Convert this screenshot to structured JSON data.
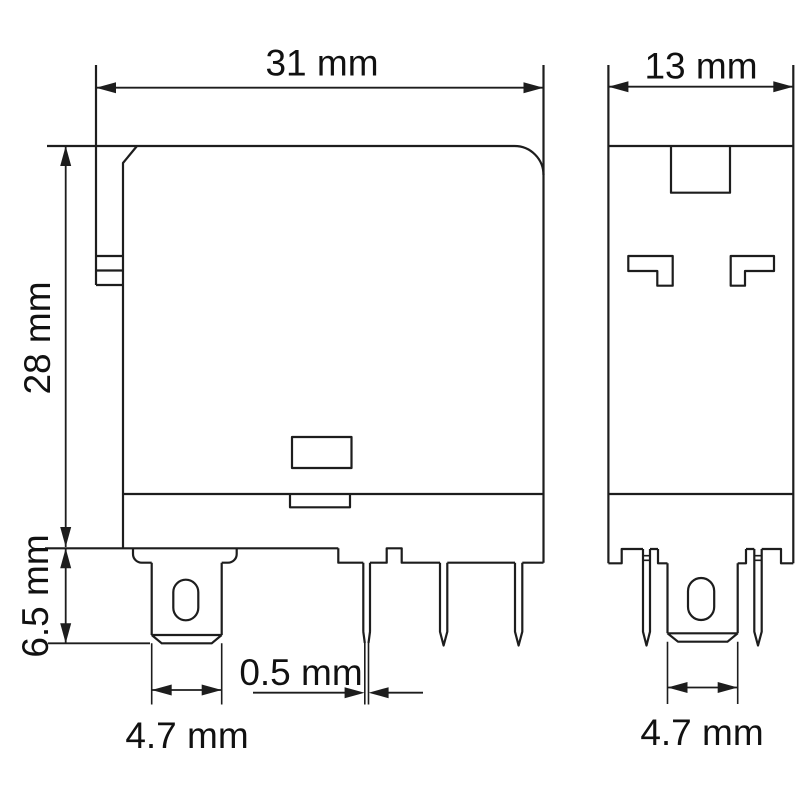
{
  "drawing": {
    "dimensions": {
      "front_width": "31 mm",
      "side_width": "13 mm",
      "body_height": "28 mm",
      "pin_length": "6.5 mm",
      "pin_thickness": "0.5 mm",
      "front_tab_width": "4.7 mm",
      "side_tab_width": "4.7 mm"
    },
    "colors": {
      "line": "#1d1d1d",
      "text": "#111111",
      "background": "#ffffff"
    }
  }
}
